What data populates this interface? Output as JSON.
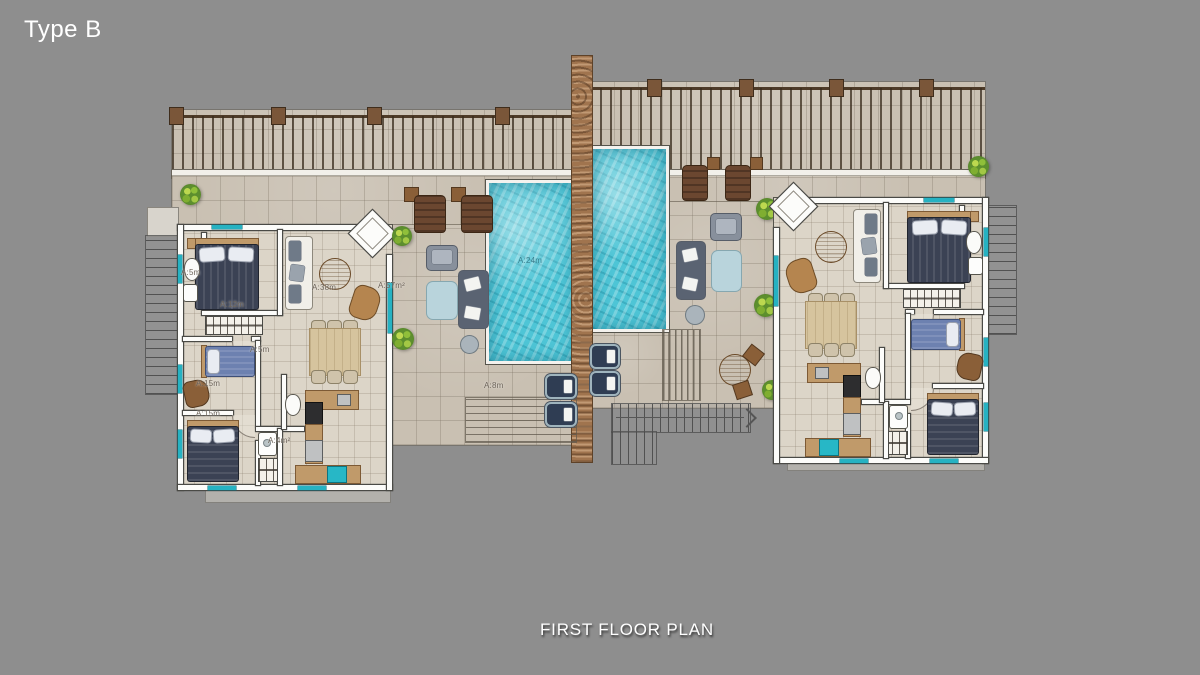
{
  "page": {
    "type_label": "Type B",
    "plan_title": "FIRST FLOOR PLAN"
  },
  "area_labels": {
    "terrace": "A:57m²",
    "pool": "A:24m",
    "deck_stairs": "A:8m",
    "master_bedroom": "A:12m",
    "living_room": "A:38m",
    "bathroom": "A:5m",
    "hall": "A:5m",
    "bedroom_2": "A:15m",
    "bedroom_3": "A:15m",
    "bathroom_2": "A:4m²"
  },
  "colors": {
    "background": "#8e8e8e",
    "deck_tile": "#c9c0b2",
    "interior_tile": "#dcd5c8",
    "pool_water": "#4ec5d6",
    "stone_wall": "#a0744e",
    "wall_white": "#fcfcfa",
    "accent_teal": "#26b2c2",
    "title_text": "#ffffff"
  }
}
